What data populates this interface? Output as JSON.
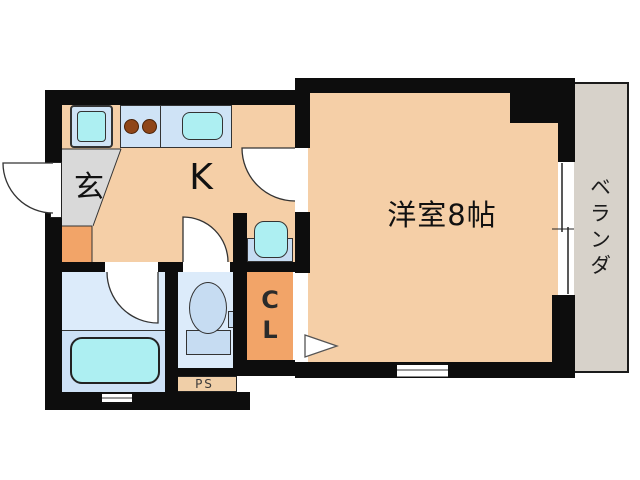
{
  "floorplan": {
    "title": "1K apartment floor plan",
    "rooms": {
      "entrance": {
        "label": "玄"
      },
      "kitchen": {
        "label": "K"
      },
      "main_room": {
        "label": "洋室8帖"
      },
      "veranda": {
        "label": "ベランダ"
      },
      "closet": {
        "label": "CL"
      },
      "pipe_space": {
        "label": "PS"
      }
    },
    "fixtures": [
      "washing-machine-pan",
      "two-burner-stove",
      "kitchen-sink",
      "wash-basin",
      "toilet",
      "bathtub"
    ],
    "colors": {
      "wall": "#0d0d0d",
      "floor_peach": "#f5cfa7",
      "entrance_gray": "#d9d9d9",
      "accent_orange": "#f2a468",
      "fixture_blue": "#cfe3f6",
      "fixture_blue_dark": "#c6dcf2",
      "water_cyan": "#adeff2",
      "bath_floor": "#dcebfa",
      "tub_area": "#cde1f6",
      "veranda_gray": "#d7d2ca",
      "ps_fill": "#f0cfa8",
      "burner_brown": "#8f4618"
    }
  }
}
